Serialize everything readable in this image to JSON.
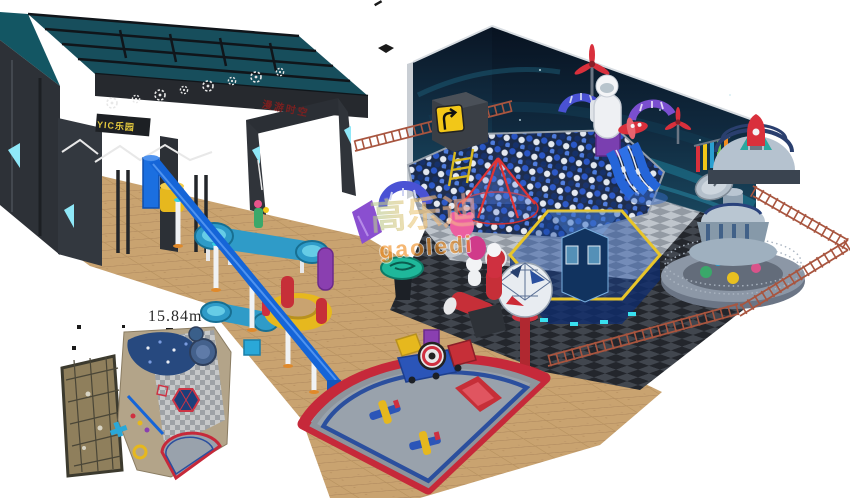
{
  "scene": {
    "description": "3D isometric render of a space and industrial themed indoor playground on a white background, with a dark entrance gate, navy space-mural walls, checkerboard floors, a ball pit, play structures and a toddler soft-play fan zone",
    "background": "#ffffff"
  },
  "labels": {
    "dimension": "15.84m",
    "gate_sign": "YIC乐园",
    "arch_sign": "漫游时空",
    "watermark_cn": "高乐迪",
    "watermark_en": "gaoledi"
  },
  "palette": {
    "gate_dark": "#2e3238",
    "gate_teal": "#17505e",
    "accent_cyan": "#8fe8f8",
    "sign_yellow": "#e3c83e",
    "arch_text_red": "#7a2020",
    "wall_navy_top": "#0a1524",
    "wall_navy_bottom": "#15324a",
    "wall_teal_streak": "#1d7d99",
    "floor_tan": "#c9a370",
    "tile_line": "#a9835a",
    "checker_light_a": "#bfc5cc",
    "checker_light_b": "#939aa3",
    "checker_dark_a": "#41464e",
    "checker_dark_b": "#23262c",
    "ball_blue": "#2a57c9",
    "ball_white": "#e9edf4",
    "tube_blue": "#1565d8",
    "fan_red": "#c6293a",
    "fan_gray": "#99a2ac",
    "fan_blue": "#2b4f9e",
    "soft_yellow": "#e6b81e",
    "rust_fence": "#a8553f",
    "dome_gray": "#b5c2cf",
    "rocket_red": "#d9303c",
    "water_table_blue": "#2f9bc8",
    "purple": "#8a3fb0",
    "watermark_orange": "#f08c1e"
  },
  "objects": [
    "entrance-gate",
    "roof-truss",
    "gear-decals",
    "archway",
    "space-wall-mural",
    "ball-pit",
    "hexagon-net-structure",
    "trampoline-pyramid",
    "geodesic-sphere",
    "ball-cannon",
    "astronaut-figure",
    "propellers",
    "toy-airplane",
    "blue-slides",
    "space-dome-with-rocket",
    "satellite-dish",
    "cone-tower",
    "round-platform",
    "rust-fences",
    "blue-tube-beam",
    "support-columns",
    "water-play-tables",
    "yellow-ring-platform",
    "toddler-fan-zone",
    "soft-train",
    "soft-airplane-blocks",
    "red-slide",
    "floor-plan-inset",
    "watermark"
  ]
}
